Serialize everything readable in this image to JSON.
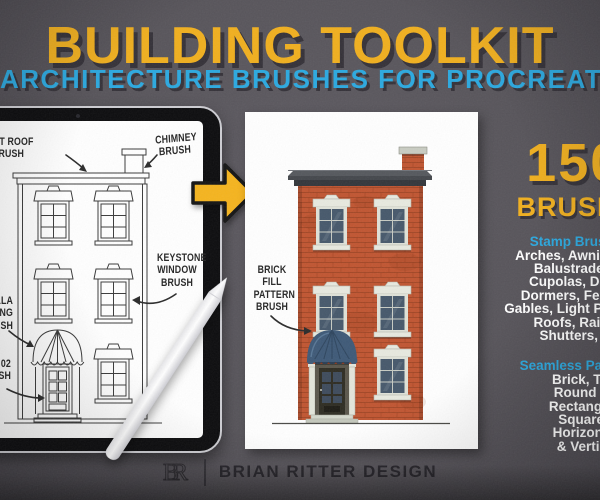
{
  "header": {
    "title": "BUILDING TOOLKIT",
    "subtitle": "ARCHITECTURE BRUSHES FOR PROCREATE"
  },
  "tablet": {
    "labels": {
      "flat_roof": "FLAT ROOF\nBRUSH",
      "chimney": "CHIMNEY\nBRUSH",
      "keystone_window": "KEYSTONE\nWINDOW\nBRUSH",
      "umbrella_awning": "UMBRELLA\nAWNING\nBRUSH",
      "door_02": "DOOR 02\nBRUSH"
    }
  },
  "card": {
    "label": "BRICK\nFILL\nPATTERN\nBRUSH"
  },
  "promo": {
    "count": "150+",
    "count_label": "BRUSHES!",
    "stamp_header": "Stamp Brushes Include:",
    "stamp_lines": [
      "Arches, Awnings, Balconies,",
      "Balustrades, Columns,",
      "Cupolas, Domes, Doors,",
      "Dormers, Fences, Fencing,",
      "Gables, Light Posts, Pediments,",
      "Roofs, Railings, Stairs,",
      "Shutters, & Windows"
    ],
    "pattern_header": "Seamless Pattern Brushes:",
    "pattern_lines": [
      "Brick, Terracotta,",
      "Round Shingles,",
      "Rectangle Blocks,",
      "Square Blocks,",
      "Horizontal Lines,",
      "& Vertical Lines"
    ]
  },
  "footer": {
    "monogram": "BR",
    "brand": "BRIAN RITTER DESIGN"
  },
  "colors": {
    "background": "#57545A",
    "title_yellow": "#F0AF1E",
    "subtitle_blue": "#2BA9E0",
    "shadow": "#343138",
    "arrow_yellow": "#F5B41E",
    "brick": "#C05531",
    "mortar": "#9E4424",
    "awning_blue": "#3E5977",
    "glass_blue": "#46586B",
    "stone_trim": "#E7E9DF",
    "cornice_gray": "#3A3D42",
    "card_white": "#FFFFFF",
    "ink": "#2B2B2B",
    "brand_ink": "#26242A"
  }
}
